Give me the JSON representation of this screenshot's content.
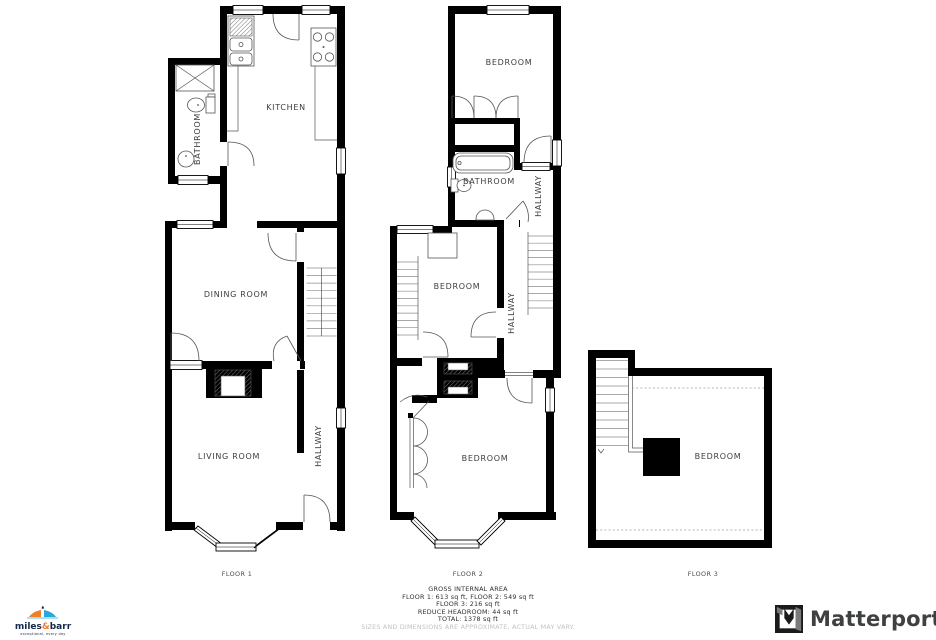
{
  "floors": [
    {
      "id": "floor-1",
      "label": "FLOOR 1",
      "rooms": {
        "kitchen": "KITCHEN",
        "bathroom": "BATHROOM",
        "dining_room": "DINING ROOM",
        "living_room": "LIVING ROOM",
        "hallway": "HALLWAY"
      }
    },
    {
      "id": "floor-2",
      "label": "FLOOR 2",
      "rooms": {
        "bedroom_front": "BEDROOM",
        "bathroom": "BATHROOM",
        "hallway_upper": "HALLWAY",
        "bedroom_middle": "BEDROOM",
        "hallway_lower": "HALLWAY",
        "bedroom_rear": "BEDROOM"
      }
    },
    {
      "id": "floor-3",
      "label": "FLOOR 3",
      "rooms": {
        "bedroom": "BEDROOM"
      }
    }
  ],
  "area_summary": {
    "title": "GROSS INTERNAL AREA",
    "lines": [
      "FLOOR 1: 613 sq ft, FLOOR 2: 549 sq ft",
      "FLOOR 3: 216 sq ft",
      "REDUCE HEADROOM: 44 sq ft",
      "TOTAL: 1378 sq ft"
    ],
    "disclaimer": "SIZES AND DIMENSIONS ARE APPROXIMATE, ACTUAL MAY VARY."
  },
  "branding": {
    "agency": {
      "word1": "miles",
      "ampersand": "&",
      "word2": "barr",
      "tagline": "exceptional, every day",
      "navy": "#14284b",
      "orange": "#f07e26",
      "blue": "#29a8e0"
    },
    "matterport": {
      "wordmark": "Matterport",
      "text_color": "#3f4042"
    }
  },
  "colors": {
    "wall": "#000000",
    "line": "#555555",
    "label": "#3d3d3d",
    "floor_label": "#4a4a4a",
    "disclaimer": "#c2c2c2"
  }
}
